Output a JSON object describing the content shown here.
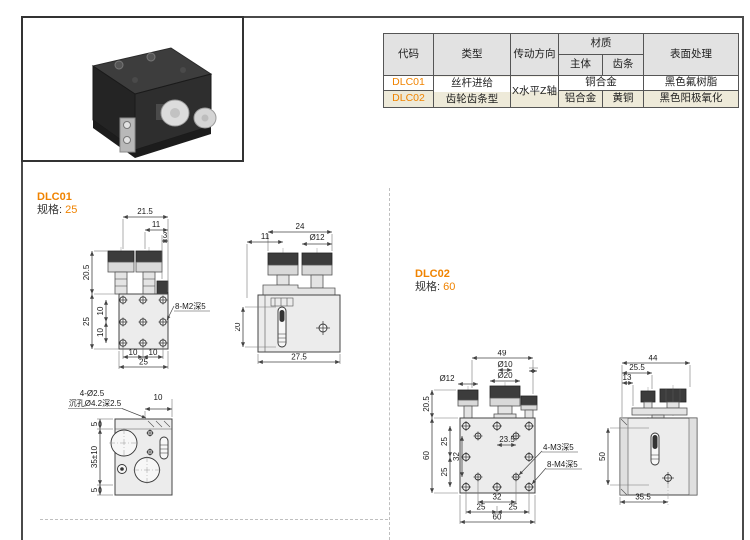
{
  "colors": {
    "accent_orange": "#f08300",
    "row_highlight": "#eeead9",
    "header_bg": "#e2e2e2",
    "drawing_line": "#444444"
  },
  "table": {
    "header": {
      "code": "代码",
      "type": "类型",
      "direction": "传动方向",
      "material": "材质",
      "material_body": "主体",
      "material_rack": "齿条",
      "surface": "表面处理"
    },
    "merged": {
      "type_line1": "丝杆进给",
      "type_line2": "齿轮齿条型",
      "direction": "X水平Z轴"
    },
    "rows": [
      {
        "code": "DLC01",
        "material": "铜合金",
        "surface": "黑色氟树脂"
      },
      {
        "code": "DLC02",
        "material_body": "铝合金",
        "material_rack": "黄铜",
        "surface": "黑色阳极氧化"
      }
    ]
  },
  "sections": {
    "dlc01": {
      "code": "DLC01",
      "spec_label": "规格:",
      "spec_value": "25"
    },
    "dlc02": {
      "code": "DLC02",
      "spec_label": "规格:",
      "spec_value": "60"
    }
  },
  "drawings": {
    "dlc01_front": {
      "dim_top_width": "21.5",
      "dim_knob_offset": "11",
      "dim_edge": "3",
      "dim_knob_height": "20.5",
      "dim_body_height": "25",
      "dim_hole_v1": "10",
      "dim_hole_v2": "10",
      "dim_hole_h1": "10",
      "dim_hole_h2": "10",
      "dim_body_width": "25",
      "label_holes": "8-M2深5"
    },
    "dlc01_side": {
      "dim_top_width": "24",
      "dim_knob_offset": "11",
      "dim_knob_dia": "Ø12",
      "dim_slot": "20",
      "dim_body_width": "27.5"
    },
    "dlc01_bottom": {
      "label_holes": "4-Ø2.5",
      "label_counterbore": "沉孔Ø4.2深2.5",
      "dim_top": "10",
      "dim_edge_top": "5",
      "dim_height": "35±10",
      "dim_edge_bottom": "5"
    },
    "dlc02_front": {
      "dim_top_width": "49",
      "dim_dia10": "Ø10",
      "dim_dia20": "Ø20",
      "dim_dia12": "Ø12",
      "dim_knob_height": "20.5",
      "dim_body_height": "60",
      "dim_hole_v1": "25",
      "dim_hole_v2": "32",
      "dim_hole_v3": "25",
      "dim_center_offset": "23.5",
      "label_m3": "4-M3深5",
      "label_m4": "8-M4深5",
      "dim_hole_h": "32",
      "dim_bottom_l": "25",
      "dim_bottom_r": "25",
      "dim_body_width": "60"
    },
    "dlc02_side": {
      "dim_top_width": "44",
      "dim_mid_width": "25.5",
      "dim_small": "13",
      "dim_slot": "50",
      "dim_body_width": "35.5"
    }
  }
}
